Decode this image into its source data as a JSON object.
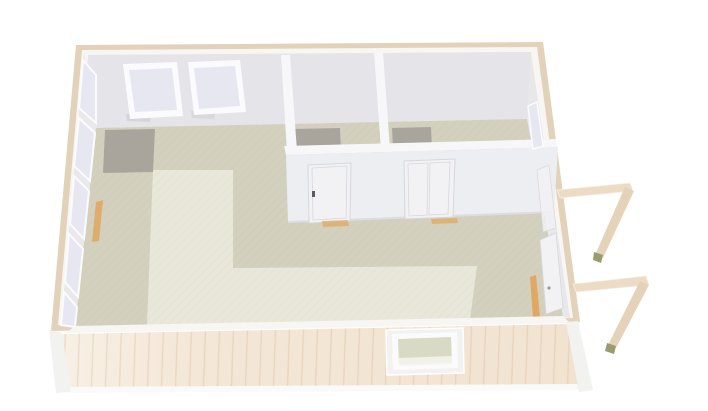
{
  "scene": {
    "type": "3d-floorplan-top-view-render",
    "description": "Top-down 3D rendering of a rectangular cabin / modular building without roof, two small rooms top-right, L-shaped light rug in main room, exterior handrails at right entrances",
    "rooms": [
      {
        "name": "main-room",
        "floor": "khaki",
        "rug": "light-cream-L-shape",
        "entry_mat": "gray"
      },
      {
        "name": "small-room-left",
        "floor": "khaki",
        "entry_mat": "gray",
        "door": "single interior door"
      },
      {
        "name": "small-room-right",
        "floor": "khaki",
        "entry_mat": "gray",
        "door": "double interior door",
        "window": "right wall window"
      }
    ],
    "objects": {
      "back_wall_windows": 2,
      "left_wall_windows": 5,
      "interior_doors": 2,
      "right_wall_doors": 2,
      "front_wall_windows": 1,
      "exterior_handrails": 2,
      "wood_thresholds": 4
    }
  },
  "colors": {
    "background": "#ffffff",
    "trim_tan": "#e3d2ba",
    "wall_top": "#f7f6f3",
    "wall_face": "#e7e7ea",
    "back_wall_face": "#e5e4e8",
    "left_wall_face": "#e9e9ec",
    "right_wall_face": "#e8e8eb",
    "partition_top": "#f7f7f9",
    "partition_face": "#edeef1",
    "floor_khaki": "#d3d1bd",
    "floor_light": "#e9e7d9",
    "mat_gray": "#a9a59d",
    "window_frame": "#fbfbfd",
    "glass_lavender": "#e7e7f2",
    "glass_green": "#d9dac4",
    "exterior_wood": "#f5e9da",
    "exterior_wood_dark": "#efdfcc",
    "base_trim": "#fafaf8",
    "corner_trim": "#f2f2f0",
    "threshold_orange": "#e0a862",
    "railing": "#ecdcc5",
    "railing_shade": "#e5d3b9",
    "railing_cap": "#9b9b70",
    "door_face": "#f2f2f5",
    "door_line": "#d6d7dd",
    "handle_dark": "#5c5c66",
    "shadow_soft": "#c9c9cd"
  }
}
